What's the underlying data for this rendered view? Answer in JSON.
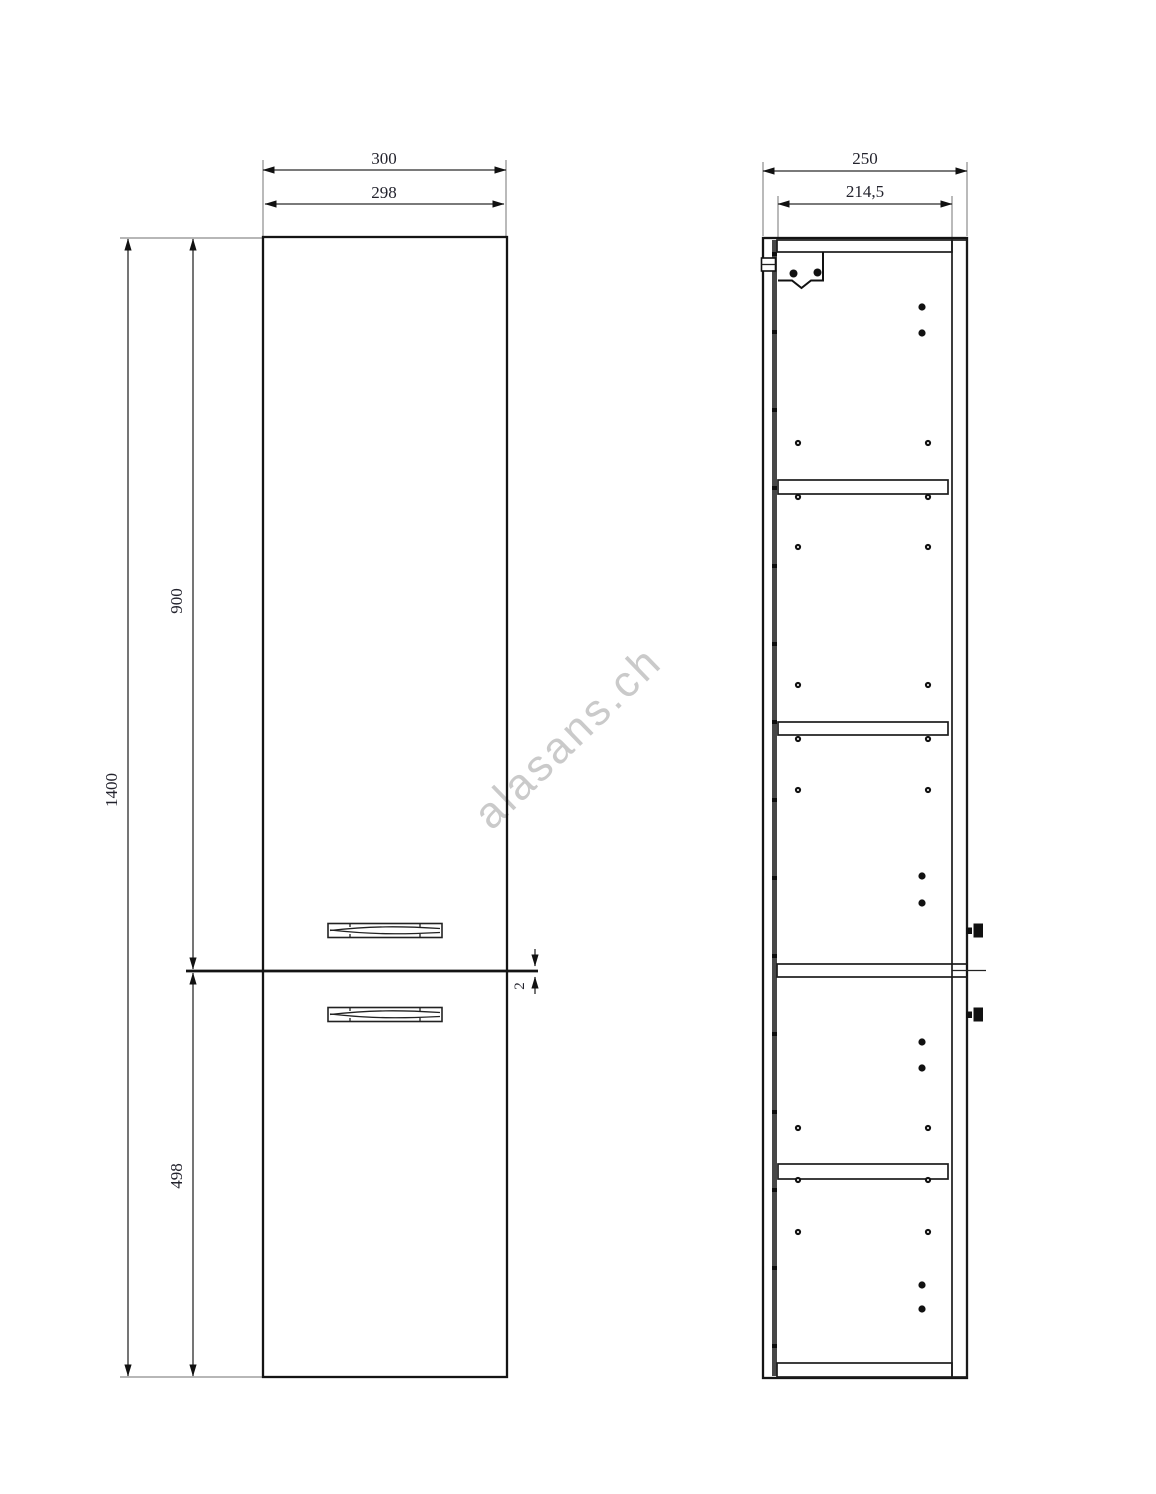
{
  "watermark": {
    "text": "alasans.ch",
    "color": "#c8c8c8"
  },
  "front_view": {
    "dims": {
      "width_outer": "300",
      "width_inner": "298",
      "height_total": "1400",
      "door_top_height": "900",
      "door_bottom_height": "498",
      "door_gap": "2"
    }
  },
  "side_view": {
    "dims": {
      "depth_outer": "250",
      "depth_inner": "214,5"
    }
  },
  "line_color": "#141414"
}
